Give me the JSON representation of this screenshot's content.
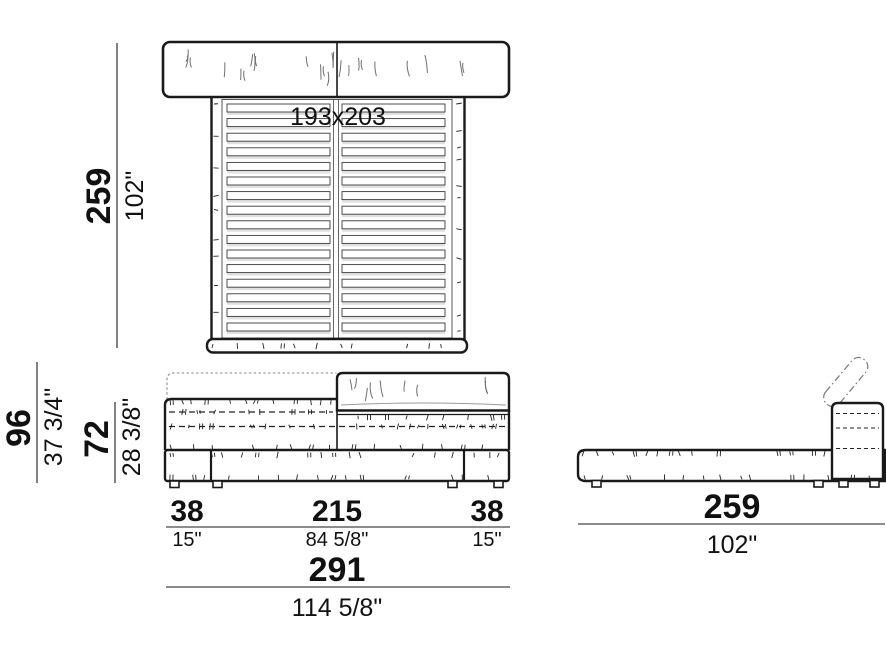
{
  "drawing": {
    "title": "bed-technical-dimension-drawing",
    "top_view": {
      "mattress_label": "193x203",
      "length": {
        "cm": "259",
        "inch": "102\""
      }
    },
    "front_view": {
      "height_total": {
        "cm": "96",
        "inch": "37 3/4\""
      },
      "height_base": {
        "cm": "72",
        "inch": "28 3/8\""
      },
      "width_left": {
        "cm": "38",
        "inch": "15\""
      },
      "width_center": {
        "cm": "215",
        "inch": "84 5/8\""
      },
      "width_right": {
        "cm": "38",
        "inch": "15\""
      },
      "width_total": {
        "cm": "291",
        "inch": "114 5/8\""
      }
    },
    "side_view": {
      "depth": {
        "cm": "259",
        "inch": "102\""
      }
    },
    "colors": {
      "line": "#1a1a1a",
      "wrinkle": "#6f6f6f",
      "dotted_outline": "#8a8a8a"
    }
  }
}
